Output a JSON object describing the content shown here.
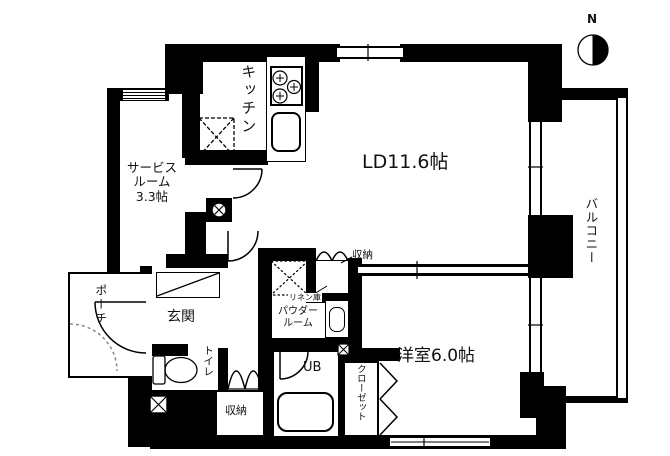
{
  "palette": {
    "wall_color": "#000000",
    "background": "#ffffff",
    "dash_color": "#888888"
  },
  "compass": {
    "label": "N"
  },
  "rooms": {
    "kitchen": {
      "label": "キッチン"
    },
    "living_dining": {
      "label": "LD11.6帖"
    },
    "service_room": {
      "lines": [
        "サービス",
        "ルーム",
        "3.3帖"
      ]
    },
    "balcony": {
      "label": "バルコニー"
    },
    "entrance": {
      "label": "玄関"
    },
    "porch": {
      "label": "ポーチ"
    },
    "toilet": {
      "label": "トイレ"
    },
    "powder_room": {
      "lines": [
        "パウダー",
        "ルーム"
      ]
    },
    "linen_storage": {
      "label": "リネン庫"
    },
    "ld_storage": {
      "label": "収納"
    },
    "unit_bath": {
      "label": "UB"
    },
    "closet": {
      "label": "クローゼット"
    },
    "hall_storage": {
      "label": "収納"
    },
    "western_room": {
      "label": "洋室6.0帖"
    }
  },
  "fixtures": [
    "stove",
    "sink",
    "refrigerator-space",
    "washing-machine-space",
    "washbasin",
    "bathtub",
    "toilet",
    "shoe-cabinet",
    "compass-rose",
    "pipe-space",
    "door-swing",
    "folding-door"
  ]
}
